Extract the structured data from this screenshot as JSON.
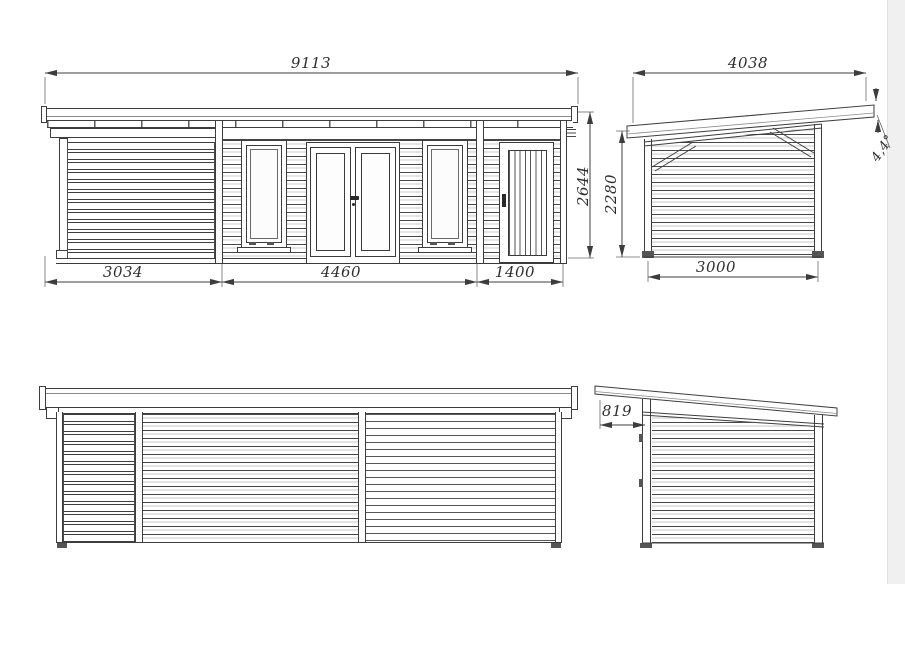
{
  "title": "garden-house-technical-drawing",
  "colors": {
    "line": "#3d3d3d",
    "background": "#ffffff",
    "side_panel": "#f0f0f1"
  },
  "views": {
    "front_elevation": {
      "dimensions": {
        "overall_width": "9113",
        "overall_height": "2644",
        "terrace_width": "3034",
        "cabin_width": "4460",
        "annex_width": "1400"
      }
    },
    "right_side_elevation": {
      "dimensions": {
        "overall_depth": "4038",
        "wall_height": "2280",
        "wall_depth": "3000",
        "roof_pitch": "4,4°"
      }
    },
    "rear_elevation": {
      "dimensions": {}
    },
    "left_side_elevation": {
      "dimensions": {
        "roof_overhang": "819"
      }
    }
  }
}
